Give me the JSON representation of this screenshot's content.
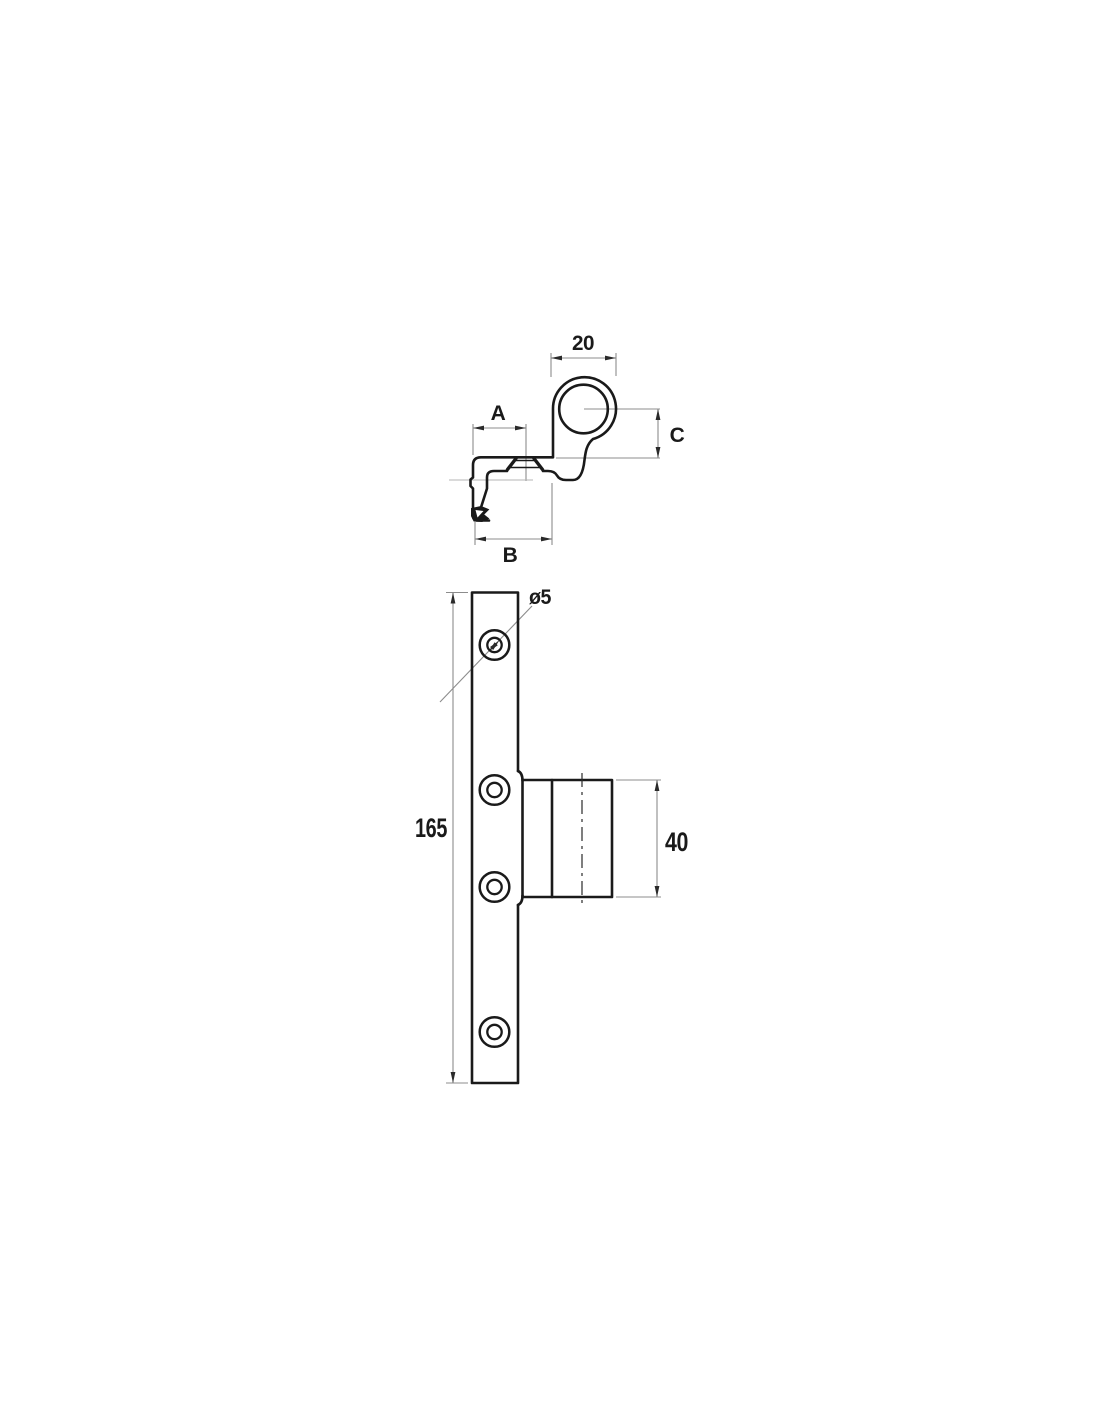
{
  "drawing": {
    "type": "technical_drawing",
    "description": "Two-view engineering drawing of a hinge bracket: side profile view with ring knuckle (top) and front elevation with four countersunk screw holes and pin barrel (bottom)",
    "colors": {
      "background": "#ffffff",
      "object_line": "#1a1a1a",
      "dimension_line": "#8c8c8c",
      "arrow": "#2a2a2a",
      "text": "#1a1a1a"
    },
    "side_view": {
      "name": "side-profile-view",
      "labels": {
        "ring_width": "20",
        "plate_offset": "A",
        "ring_center_height": "C",
        "total_depth": "B"
      }
    },
    "front_view": {
      "name": "front-elevation-view",
      "labels": {
        "hole_diameter": "ø5",
        "plate_length": "165",
        "barrel_height": "40"
      },
      "hole_count": 4
    }
  }
}
